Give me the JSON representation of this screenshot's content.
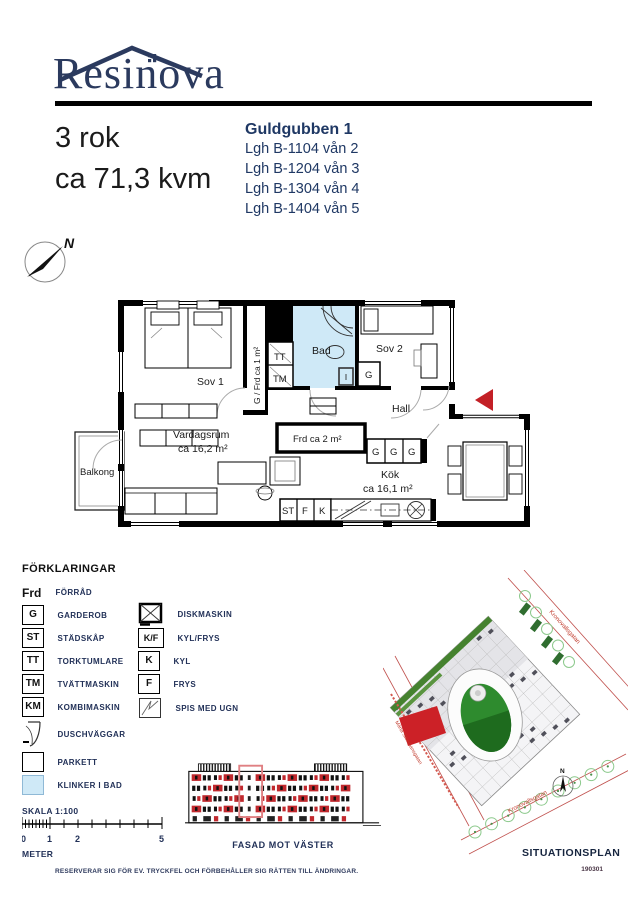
{
  "header": {
    "logo": "Resinova"
  },
  "title": {
    "rooms": "3 rok",
    "area": "ca 71,3 kvm"
  },
  "building": {
    "name": "Guldgubben 1",
    "apartments": [
      "Lgh B-1104 vån 2",
      "Lgh B-1204 vån 3",
      "Lgh B-1304 vån 4",
      "Lgh B-1404 vån 5"
    ]
  },
  "compass": {
    "north": "N"
  },
  "floorplan": {
    "sov1": "Sov 1",
    "sov2": "Sov 2",
    "bad": "Bad",
    "hall": "Hall",
    "vardagsrum": "Vardagsrum",
    "vardagsrum_area": "ca 16,2 m²",
    "kok": "Kök",
    "kok_area": "ca 16,1 m²",
    "balkong": "Balkong",
    "frd2": "Frd ca 2 m²",
    "closet_strip": "G / Frd ca 1 m²",
    "tt": "TT",
    "tm": "TM",
    "g": "G",
    "st": "ST",
    "f": "F",
    "k": "K"
  },
  "legend": {
    "heading": "FÖRKLARINGAR",
    "frd": {
      "key": "Frd",
      "label": "FÖRRÅD"
    },
    "left": [
      {
        "key": "G",
        "label": "GARDEROB"
      },
      {
        "key": "ST",
        "label": "STÄDSKÅP"
      },
      {
        "key": "TT",
        "label": "TORKTUMLARE"
      },
      {
        "key": "TM",
        "label": "TVÄTTMASKIN"
      },
      {
        "key": "KM",
        "label": "KOMBIMASKIN"
      }
    ],
    "dusch": "DUSCHVÄGGAR",
    "parkett": "PARKETT",
    "klinker": "KLINKER I BAD",
    "right": [
      {
        "key": "",
        "label": "DISKMASKIN"
      },
      {
        "key": "K/F",
        "label": "KYL/FRYS"
      },
      {
        "key": "K",
        "label": "KYL"
      },
      {
        "key": "F",
        "label": "FRYS"
      },
      {
        "key": "",
        "label": "SPIS MED UGN"
      }
    ]
  },
  "scale": {
    "label": "SKALA 1:100",
    "meter": "METER",
    "t0": "0",
    "t1": "1",
    "t2": "2",
    "t5": "5"
  },
  "facade": {
    "label": "FASAD MOT VÄSTER"
  },
  "siteplan": {
    "label": "SITUATIONSPLAN",
    "north": "N",
    "street_right": "Kronovallsgatan",
    "street_left": "Märta Stenmansgatan",
    "street_bottom": "Kronovallsgatan"
  },
  "footer": {
    "disclaimer": "RESERVERAR SIG FÖR EV. TRYCKFEL OCH FÖRBEHÅLLER SIG RÄTTEN TILL ÄNDRINGAR.",
    "code": "190301"
  },
  "colors": {
    "navy": "#1f3864",
    "logo_navy": "#2b3a5e",
    "bath_blue": "#cfe9f7",
    "entrance_red": "#c32026",
    "facade_red": "#c0282d",
    "site_green": "#2e8b2e"
  }
}
